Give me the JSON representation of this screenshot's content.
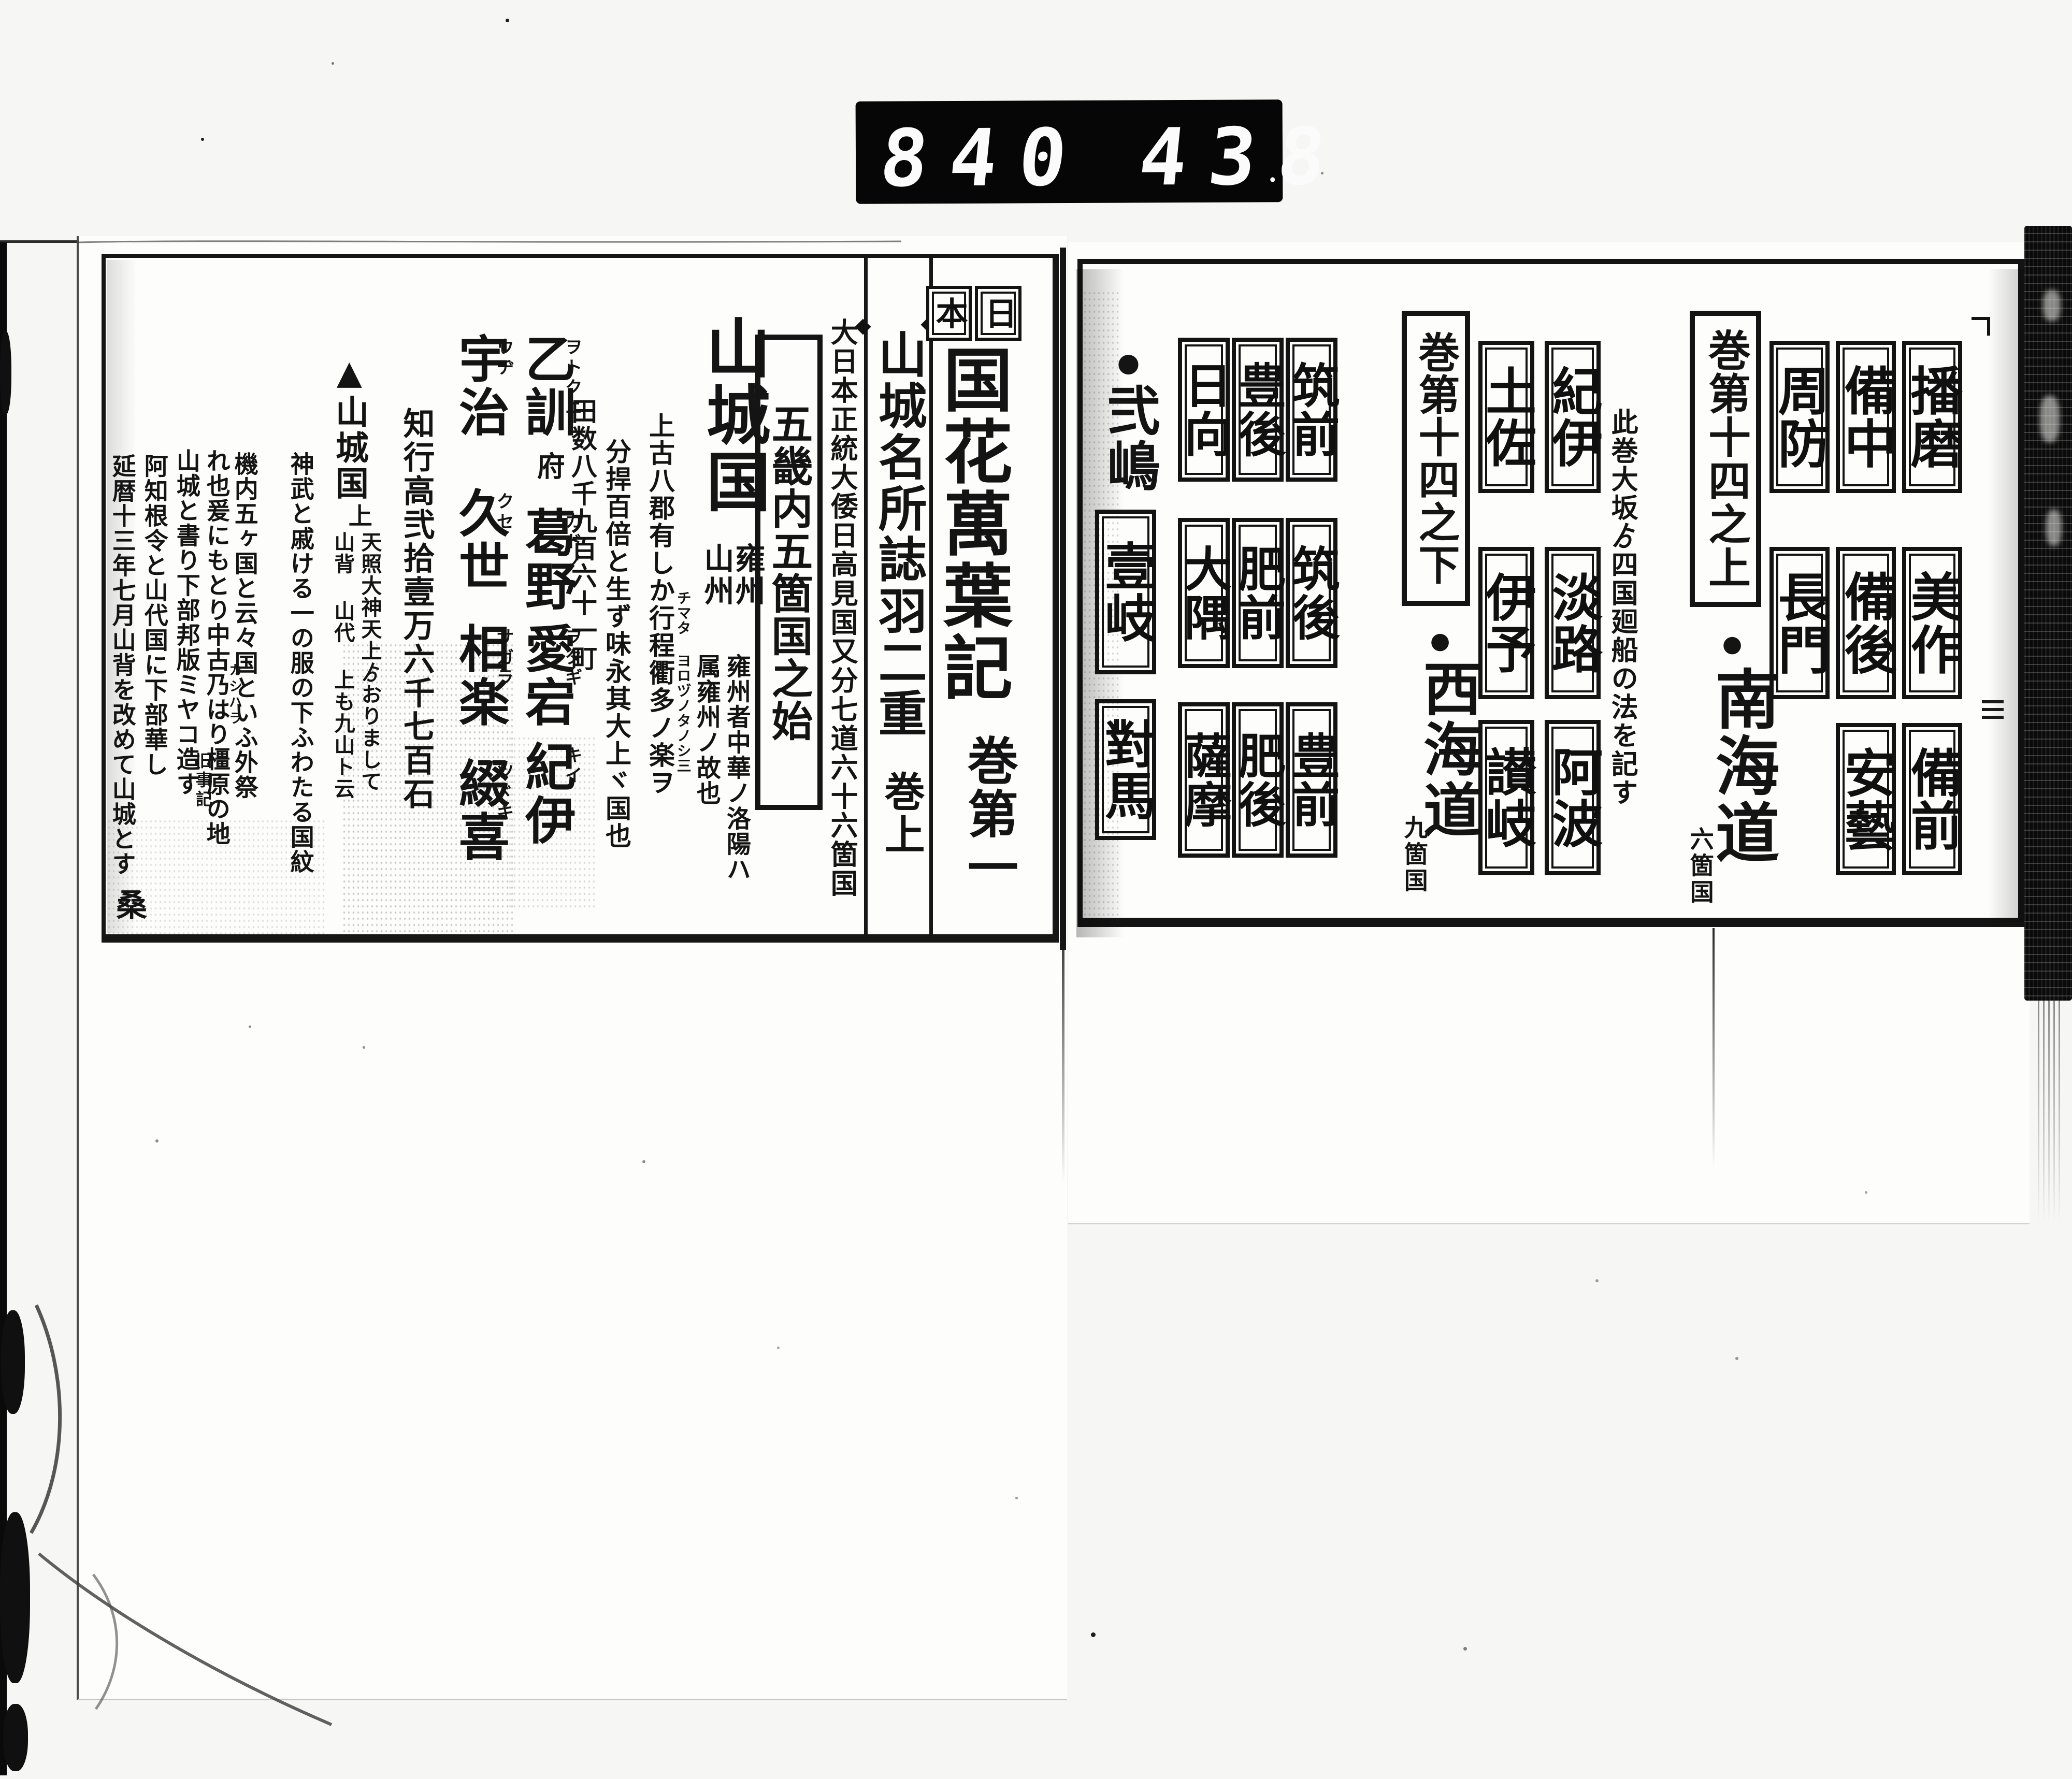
{
  "counter": {
    "left_digits": "840",
    "right_digits": "438"
  },
  "right_page": {
    "sanyo": {
      "boxes": [
        "播磨",
        "備中",
        "周防",
        "美作",
        "備後",
        "長門",
        "備前",
        "安藝"
      ]
    },
    "nankai": {
      "volume_label": "巻第十四之上",
      "bullet": "●",
      "road_label": "南海道",
      "count_label": "六箇国",
      "note": "此巻大坂ゟ四国廻船の法を記す",
      "boxes": [
        "紀伊",
        "土佐",
        "淡路",
        "伊予",
        "阿波",
        "讃岐"
      ]
    },
    "saikai": {
      "volume_label": "巻第十四之下",
      "bullet": "●",
      "road_label": "西海道",
      "count_label": "九箇国",
      "boxes": [
        "筑前",
        "豊後",
        "日向",
        "筑後",
        "肥前",
        "大隅",
        "豊前",
        "肥後",
        "薩摩"
      ]
    },
    "islands": {
      "bullet": "●",
      "group_label": "弐嶋",
      "boxes": [
        "壹岐",
        "對馬"
      ]
    }
  },
  "left_page": {
    "country_label_chars": [
      "日",
      "本"
    ],
    "main_title": "国花萬葉記",
    "main_volume": "巻第一",
    "subtitle": "山城名所誌羽二重",
    "sub_volume": "巻上",
    "seven_roads_note": "大日本正統大倭日高見国又分七道六十六箇国",
    "gokinai_label": "五畿内五箇国之始",
    "province_title": "山城国",
    "province_alt_right": "雍州",
    "province_alt_left": "山州",
    "yoshu_note_right": "雍州者中華ノ洛陽ハ",
    "yoshu_note_left": "属雍州ノ故也",
    "geo_note_1": "上古八郡有しか行程衢多ノ楽ヲ",
    "geo_note_1_kana": "チマタ ヨロヅノタノシ三",
    "geo_note_2": "分捍百倍と生ず味永其大上ヾ国也",
    "geo_note_3": "田数八千九百六十一町",
    "districts_east": [
      {
        "kanji": "乙訓",
        "kana": "ヲトクニ"
      },
      {
        "kanji": "葛野",
        "kana": "カドノ"
      },
      {
        "kanji": "愛宕",
        "kana": "ヲタギ"
      },
      {
        "kanji": "紀伊",
        "kana": "キイ"
      }
    ],
    "district_capital_mark": "府",
    "districts_west": [
      {
        "kanji": "宇治",
        "kana": "ウヂ"
      },
      {
        "kanji": "久世",
        "kana": "クセ"
      },
      {
        "kanji": "相楽",
        "kana": "サガラ"
      },
      {
        "kanji": "綴喜",
        "kana": "ツヾキ"
      }
    ],
    "kokudaka": "知行高弐拾壹万六千七百石",
    "etymology_head": "▲山城国",
    "etymology_head_sub": "上",
    "etymology_sub_right": "天照大神天上ゟおりまして",
    "etymology_sub_left": "山背 山代 上も九山ト云",
    "etymology_col_2": "神武と戚ける一の服の下ふわたる国紋",
    "etymology_col_3": "機内五ヶ国と云々国といふ外祭",
    "etymology_col_4": "れ也爰にもとり中古乃はり橿原の地",
    "etymology_col_4_kana": "カシハラ",
    "etymology_col_5": "山城と書り下部邦版ミヤコ造す",
    "etymology_col_5_cite": "旧事記",
    "etymology_col_6": "阿知根令と山代国に下部華し",
    "etymology_col_7": "延暦十三年七月山背を改めて山城とす",
    "etymology_col_7_end": "桑"
  }
}
